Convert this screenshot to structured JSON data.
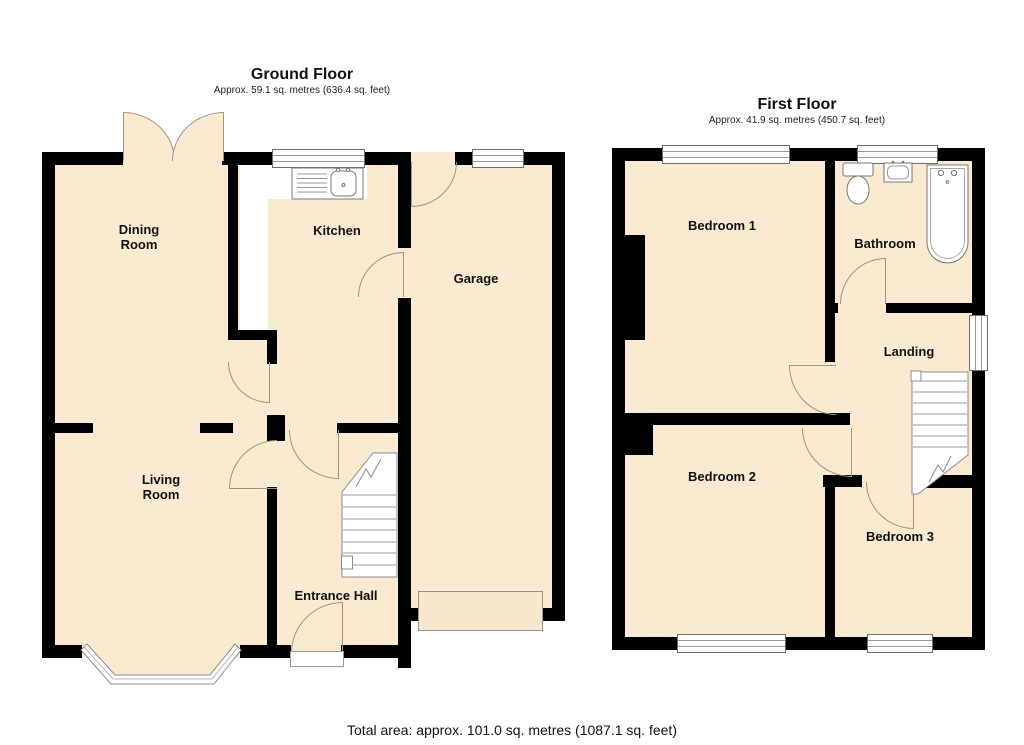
{
  "floors": [
    {
      "title": "Ground Floor",
      "area_label": "Approx. 59.1 sq. metres (636.4 sq. feet)",
      "rooms": [
        {
          "name": "Dining Room"
        },
        {
          "name": "Kitchen"
        },
        {
          "name": "Garage"
        },
        {
          "name": "Living Room"
        },
        {
          "name": "Entrance Hall"
        }
      ]
    },
    {
      "title": "First Floor",
      "area_label": "Approx. 41.9 sq. metres (450.7 sq. feet)",
      "rooms": [
        {
          "name": "Bedroom 1"
        },
        {
          "name": "Bathroom"
        },
        {
          "name": "Landing"
        },
        {
          "name": "Bedroom 2"
        },
        {
          "name": "Bedroom 3"
        }
      ]
    }
  ],
  "footer": {
    "total_area": "Total area: approx. 101.0 sq. metres (1087.1 sq. feet)"
  },
  "fixtures": [
    "staircase-icon",
    "kitchen-sink-icon",
    "toilet-icon",
    "washbasin-icon",
    "bathtub-icon",
    "bay-window-icon",
    "garage-door-icon",
    "door-step-icon",
    "french-doors-icon",
    "window-icon",
    "door-arc-icon"
  ],
  "colors": {
    "floor_fill": "#FAEAD1",
    "wall": "#000000",
    "door_arc": "#A6917A",
    "fixture_outline": "#777777",
    "window_frame": "#6e6e6e"
  }
}
